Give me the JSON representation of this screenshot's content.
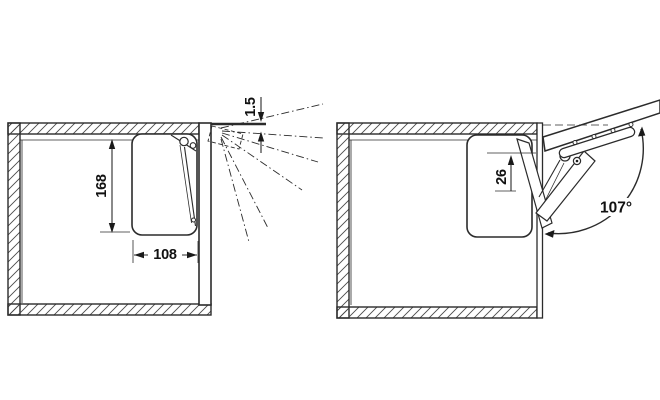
{
  "colors": {
    "line": "#2b2b2b",
    "background": "#ffffff"
  },
  "views": {
    "closed": {
      "dim_gap": "1.5",
      "dim_height": "168",
      "dim_depth": "108"
    },
    "open": {
      "dim_pivot": "26",
      "dim_angle": "107°"
    }
  }
}
